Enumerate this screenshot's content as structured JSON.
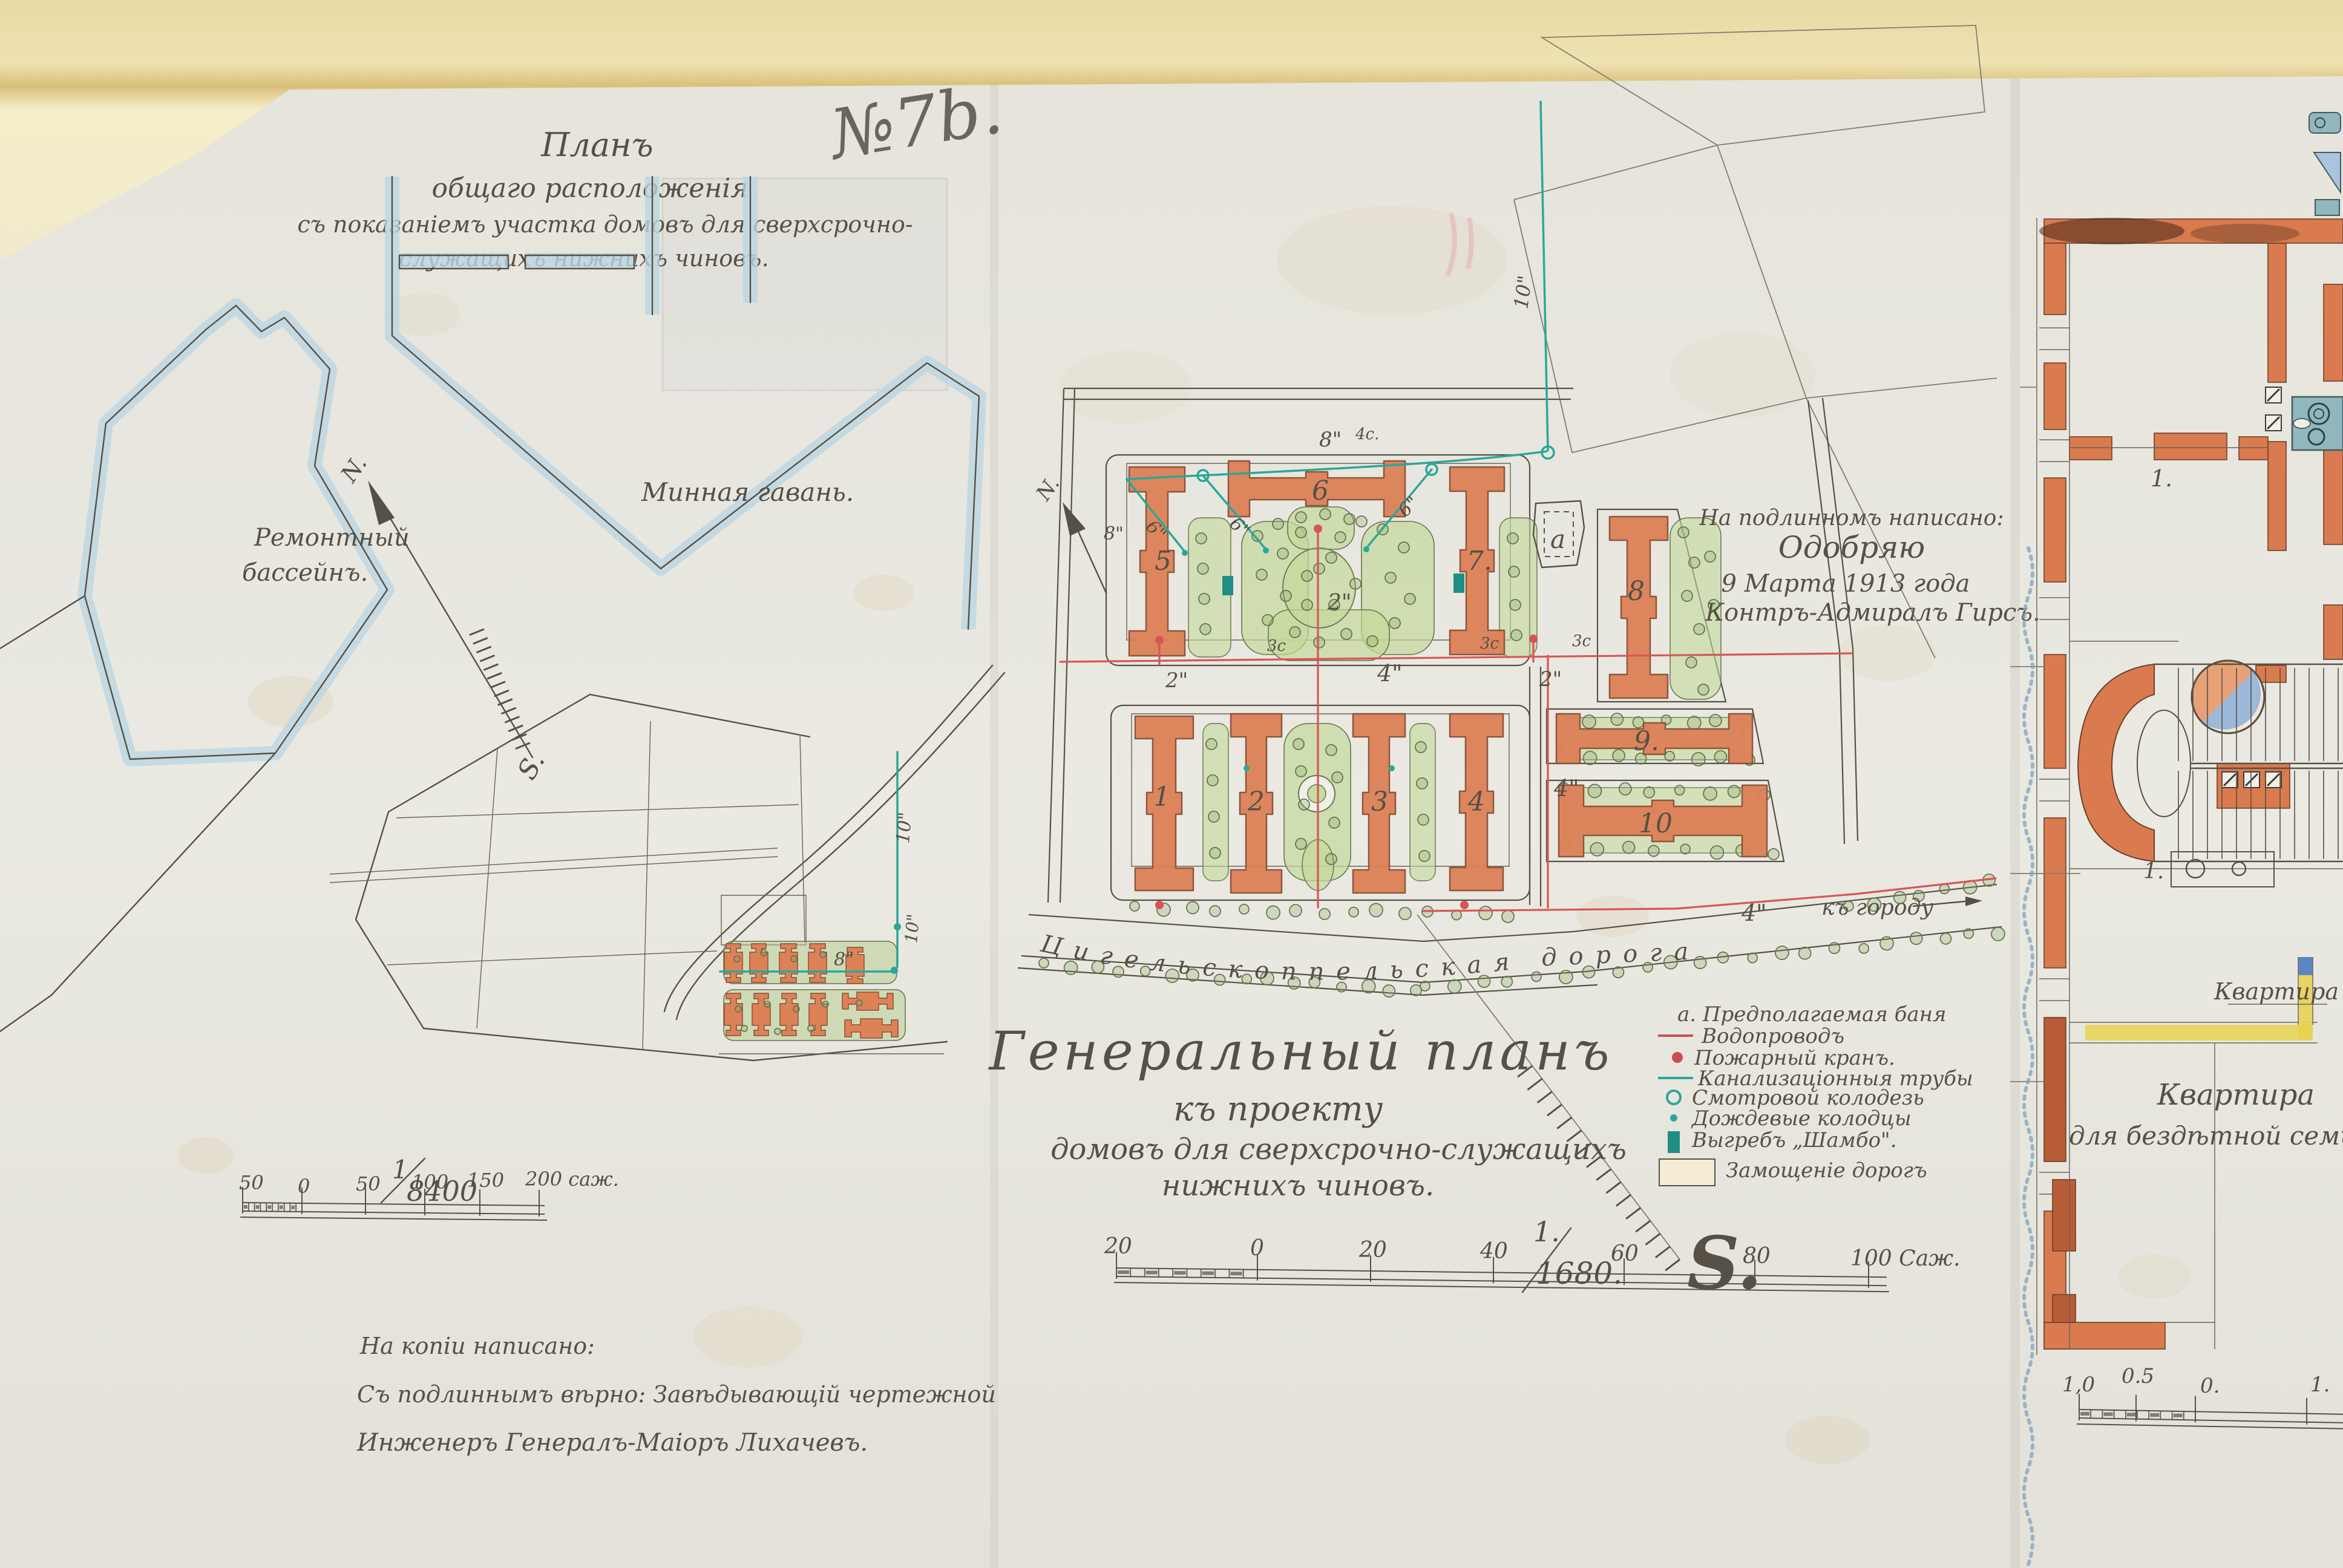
{
  "document": {
    "sheet_number": "№7b."
  },
  "left_panel": {
    "title": [
      "Планъ",
      "общаго расположенія",
      "съ показаніемъ участка домовъ для сверхсрочно-",
      "служащихъ нижнихъ чиновъ."
    ],
    "labels": {
      "repair_basin_1": "Ремонтный",
      "repair_basin_2": "бассейнъ.",
      "mine_harbor": "Минная гавань.",
      "north": "N.",
      "south": "S."
    },
    "pipes": {
      "v10": "10\"",
      "v10b": "10\"",
      "v8": "8\""
    },
    "scale": {
      "numerator": "1",
      "denominator": "8400",
      "ticks": [
        "50",
        "0",
        "50",
        "100",
        "150",
        "200 саж."
      ]
    },
    "copy_note": [
      "На копіи написано:",
      "Съ подлиннымъ вѣрно: Завѣдывающій чертежной",
      "Инженеръ Генералъ-Маіоръ  Лихачевъ."
    ]
  },
  "center_panel": {
    "approval": [
      "На подлинномъ написано:",
      "Одобряю",
      "9 Марта 1913 года",
      "Контръ-Адмиралъ Гирсъ."
    ],
    "title": [
      "Генеральный планъ",
      "къ проекту",
      "домовъ для сверхсрочно-служащихъ",
      "нижнихъ чиновъ."
    ],
    "scale": {
      "numerator": "1.",
      "denominator": "1680.",
      "ticks": [
        "20",
        "0",
        "20",
        "40",
        "60",
        "80",
        "100 Саж."
      ]
    },
    "compass": {
      "north": "N.",
      "south": "S."
    },
    "road": {
      "name": "Цигельскоппельская дорога",
      "size": "4\"",
      "to_city": "къ городу"
    },
    "buildings": [
      "5",
      "6",
      "7.",
      "1",
      "2",
      "3",
      "4",
      "8",
      "9.",
      "10"
    ],
    "bath_letter": "а",
    "pipes": {
      "teal_8": "8\"",
      "teal_8b": "8\"",
      "teal_10": "10\"",
      "teal_6a": "6\"",
      "teal_6b": "6\"",
      "teal_6c": "6\"",
      "red_2a": "2\"",
      "red_2b": "2\"",
      "red_2c": "2\"",
      "red_4a": "4\"",
      "red_4b": "4\"",
      "red_4c": "4\"",
      "mark_4c": "4c.",
      "mark_3c_1": "3c",
      "mark_3c_2": "3c",
      "mark_3c_3": "3c"
    },
    "legend": [
      {
        "label": "а. Предполагаемая баня",
        "color": "#4a443b",
        "symbol": "letter"
      },
      {
        "label": "Водопроводъ",
        "color": "#c94f4f",
        "symbol": "red-line"
      },
      {
        "label": "Пожарный кранъ.",
        "color": "#c94f4f",
        "symbol": "red-dot"
      },
      {
        "label": "Канализаціонныя трубы",
        "color": "#2aa79b",
        "symbol": "teal-line"
      },
      {
        "label": "Смотровой колодезь",
        "color": "#2aa79b",
        "symbol": "teal-circle"
      },
      {
        "label": "Дождевые колодцы",
        "color": "#2aa79b",
        "symbol": "teal-dot"
      },
      {
        "label": "Выгребъ „Шамбо\".",
        "color": "#2aa79b",
        "symbol": "teal-rect"
      },
      {
        "label": "Замощеніе дорогъ",
        "color": "#4a443b",
        "symbol": "paved-rect"
      }
    ]
  },
  "right_panel": {
    "room_number_1": "1.",
    "room_number_2": "1.",
    "corridor_label": "Квартира",
    "apartment_label": [
      "Квартира",
      "для бездѣтной семьи"
    ],
    "scale_ticks": [
      "1,0",
      "0.5",
      "0.",
      "1."
    ]
  },
  "colors": {
    "paper": "#e8e7e0",
    "mount": "#ecdfae",
    "ink": "#565046",
    "water": "#bcd6e2",
    "building": "#dd8157",
    "garden": "#cfe0b2",
    "teal": "#2aa79b",
    "red": "#d24f4f",
    "blue_label": "#4a66b0",
    "yellow": "#e6cf56"
  }
}
